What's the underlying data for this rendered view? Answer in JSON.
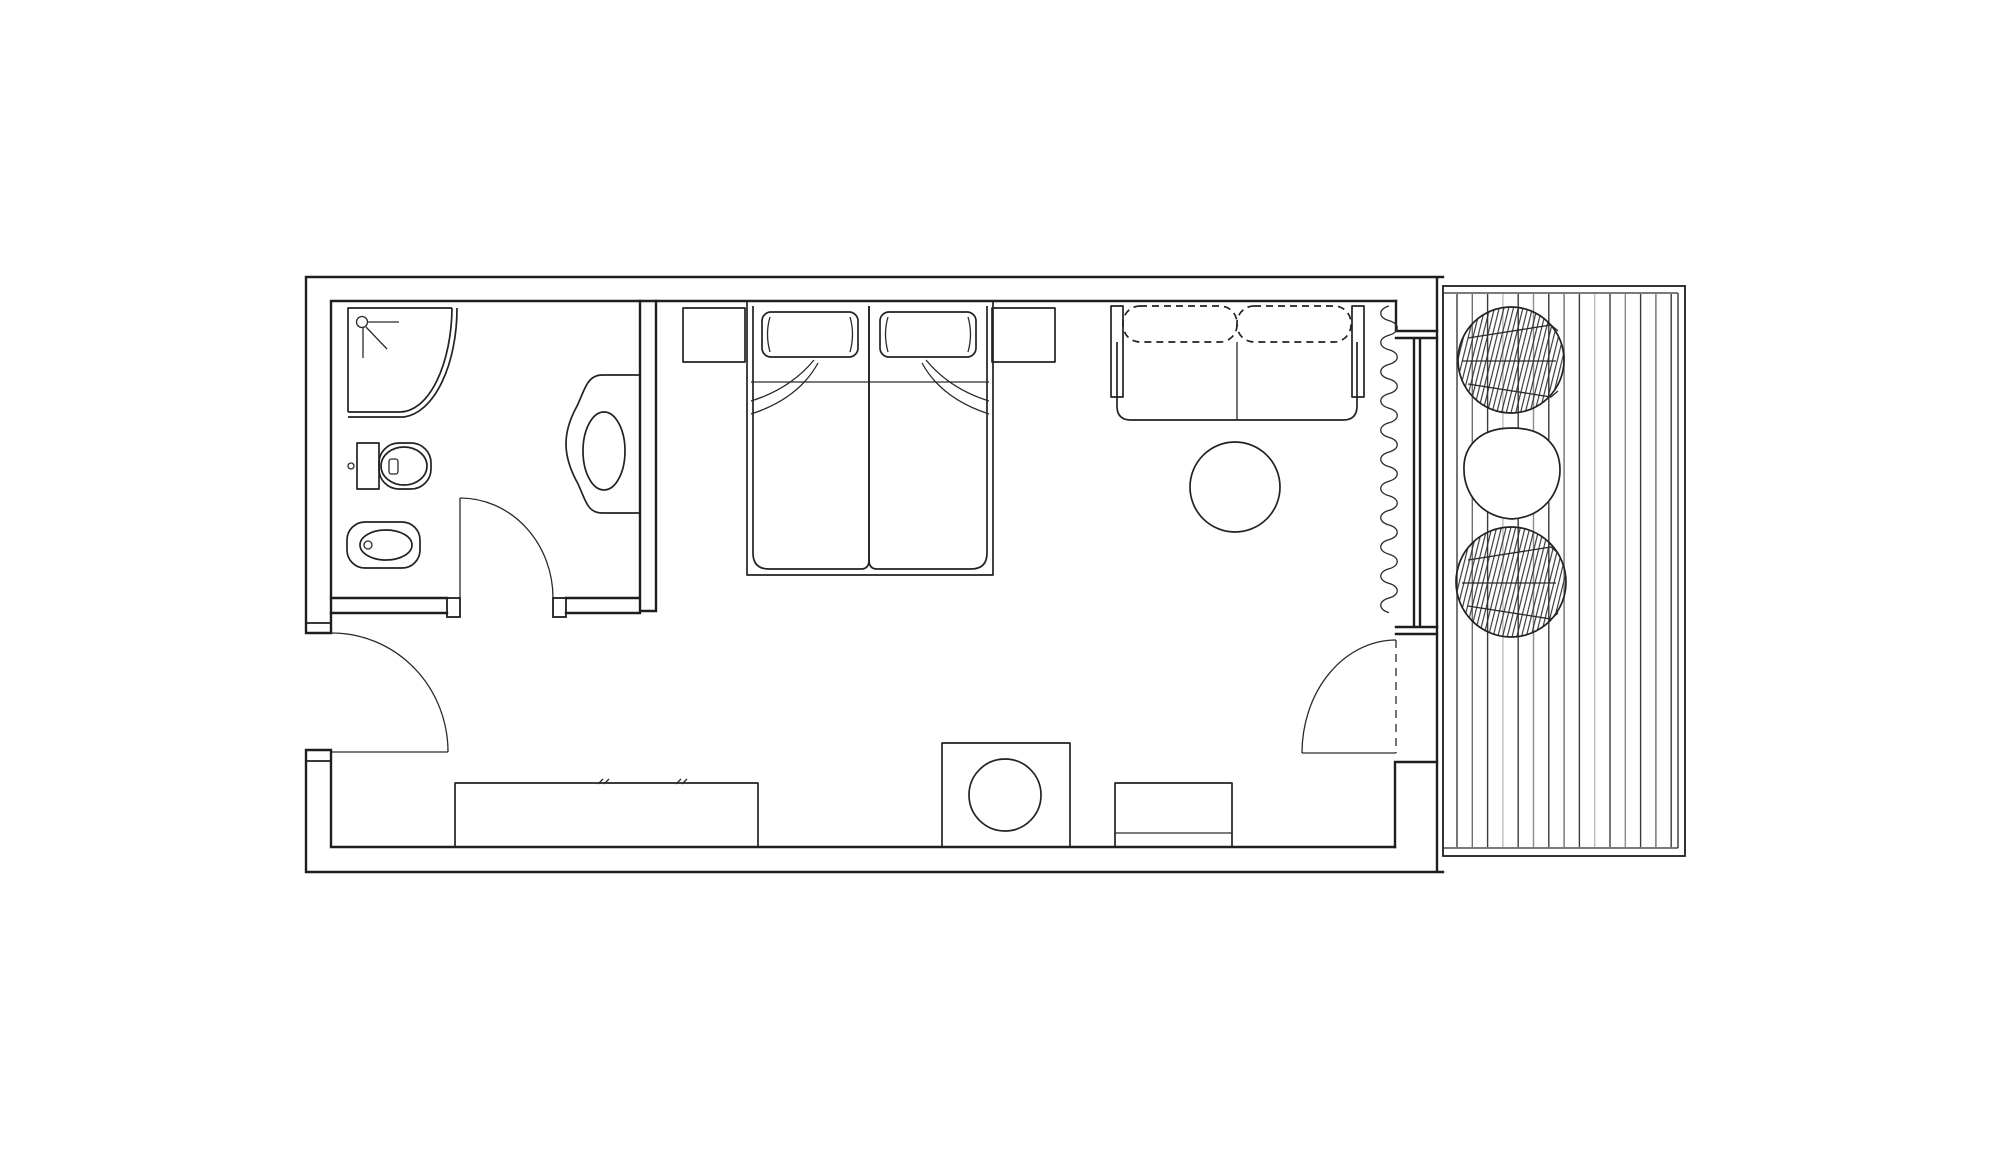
{
  "meta": {
    "title": "Studio hotel room floor plan with terrace"
  },
  "canvas": {
    "width": 2000,
    "height": 1155,
    "background": "#ffffff",
    "line_color": "#1e1e1e"
  },
  "rooms": [
    {
      "name": "bathroom"
    },
    {
      "name": "entry-hall"
    },
    {
      "name": "bedroom-living-area"
    },
    {
      "name": "terrace-deck"
    }
  ],
  "fixtures": [
    {
      "name": "corner-shower"
    },
    {
      "name": "shower-head-symbol"
    },
    {
      "name": "toilet"
    },
    {
      "name": "bidet"
    },
    {
      "name": "vanity-basin"
    }
  ],
  "furniture": [
    {
      "name": "double-bed"
    },
    {
      "name": "pillow-left"
    },
    {
      "name": "pillow-right"
    },
    {
      "name": "nightstand-left"
    },
    {
      "name": "nightstand-right"
    },
    {
      "name": "sofa-two-seat"
    },
    {
      "name": "coffee-table-round"
    },
    {
      "name": "low-counter"
    },
    {
      "name": "cabinet-with-stool"
    },
    {
      "name": "bench"
    },
    {
      "name": "terrace-chair-upper"
    },
    {
      "name": "terrace-chair-lower"
    },
    {
      "name": "terrace-table"
    }
  ],
  "doors": [
    {
      "name": "entry-door"
    },
    {
      "name": "bathroom-door"
    },
    {
      "name": "balcony-door"
    }
  ],
  "curtain": {
    "x": 1389,
    "y_start": 306,
    "y_end": 612,
    "half_loop": 14.6,
    "amplitude": 11,
    "color": "#222222"
  },
  "deck": {
    "planks": {
      "count": 15,
      "x_start": 1457,
      "spacing": 15.3,
      "y_top": 294,
      "y_bottom": 847,
      "stroke_width": 1.4,
      "colors": [
        "#3b3b3b",
        "#6f6f6f",
        "#3b3b3b",
        "#bdbdbd",
        "#3b3b3b",
        "#8c8c8c"
      ]
    }
  }
}
